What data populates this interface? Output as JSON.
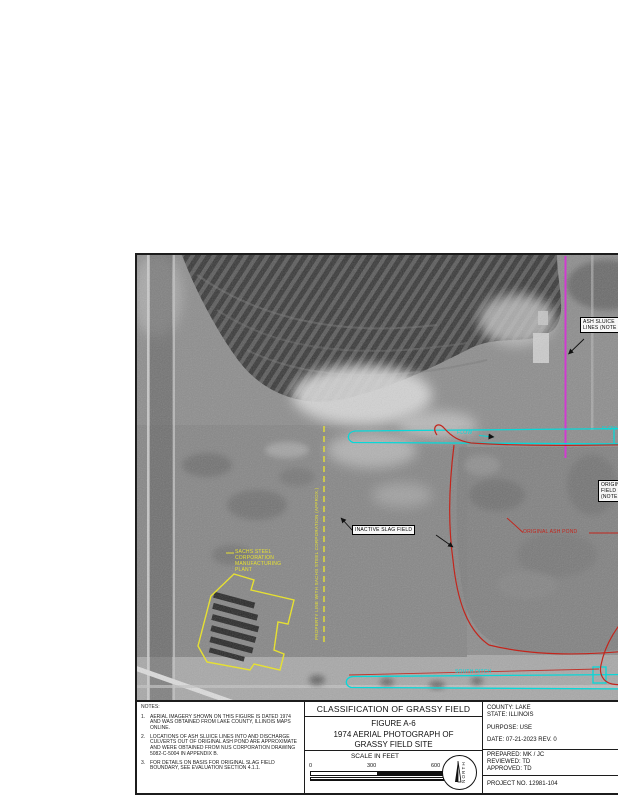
{
  "sheet": {
    "notes": {
      "heading": "NOTES:",
      "items": [
        {
          "num": "1.",
          "text": "AERIAL IMAGERY SHOWN ON THIS FIGURE IS DATED 1974 AND WAS OBTAINED FROM LAKE COUNTY, ILLINOIS MAPS ONLINE."
        },
        {
          "num": "2.",
          "text": "LOCATIONS OF ASH SLUICE LINES INTO AND DISCHARGE CULVERTS OUT OF ORIGINAL ASH POND ARE APPROXIMATE AND WERE OBTAINED FROM NUS CORPORATION DRAWING 5082-C-5004 IN APPENDIX B."
        },
        {
          "num": "3.",
          "text": "FOR DETAILS ON BASIS FOR ORIGINAL SLAG FIELD BOUNDARY, SEE EVALUATION SECTION 4.1.1."
        }
      ]
    },
    "title_block": {
      "classification": "CLASSIFICATION OF GRASSY FIELD",
      "figure_no": "FIGURE A-6",
      "title_line1": "1974 AERIAL PHOTOGRAPH OF",
      "title_line2": "GRASSY FIELD SITE",
      "scale_label": "SCALE IN FEET",
      "scale_ticks": [
        "0",
        "300",
        "600"
      ],
      "north_label": "NORTH",
      "county": "COUNTY: LAKE",
      "state": "STATE: ILLINOIS",
      "purpose": "PURPOSE: USE",
      "date": "DATE: 07-21-2023   REV. 0",
      "prepared": "PREPARED: MK / JC",
      "reviewed": "REVIEWED: TD",
      "approved": "APPROVED: TD",
      "project_no": "PROJECT NO. 12981-104"
    },
    "map": {
      "labels": {
        "ash_sluice": {
          "lines": [
            "ASH SLUICE",
            "LINES (NOTE 2)"
          ]
        },
        "inactive_slag_field": "INACTIVE SLAG FIELD",
        "original_ash_pond": "ORIGINAL ASH POND",
        "original_slag": {
          "lines": [
            "ORIGINAL SLAG",
            "FIELD",
            "(NOTE 3)"
          ]
        },
        "plant": {
          "lines": [
            "SACHS STEEL",
            "CORPORATION",
            "MANUFACTURING",
            "PLANT"
          ]
        },
        "property_line": "PROPERTY LINE WITH SACHS STEEL CORPORATION (APPROX.)",
        "flow": "FLOW",
        "flow_right_fragment": "FLOW",
        "south_ditch": "SOUTH DITCH"
      },
      "colors": {
        "magenta": "#d13bd1",
        "cyan": "#08d8d8",
        "red": "#c3251c",
        "yellow": "#e6e032"
      }
    }
  }
}
